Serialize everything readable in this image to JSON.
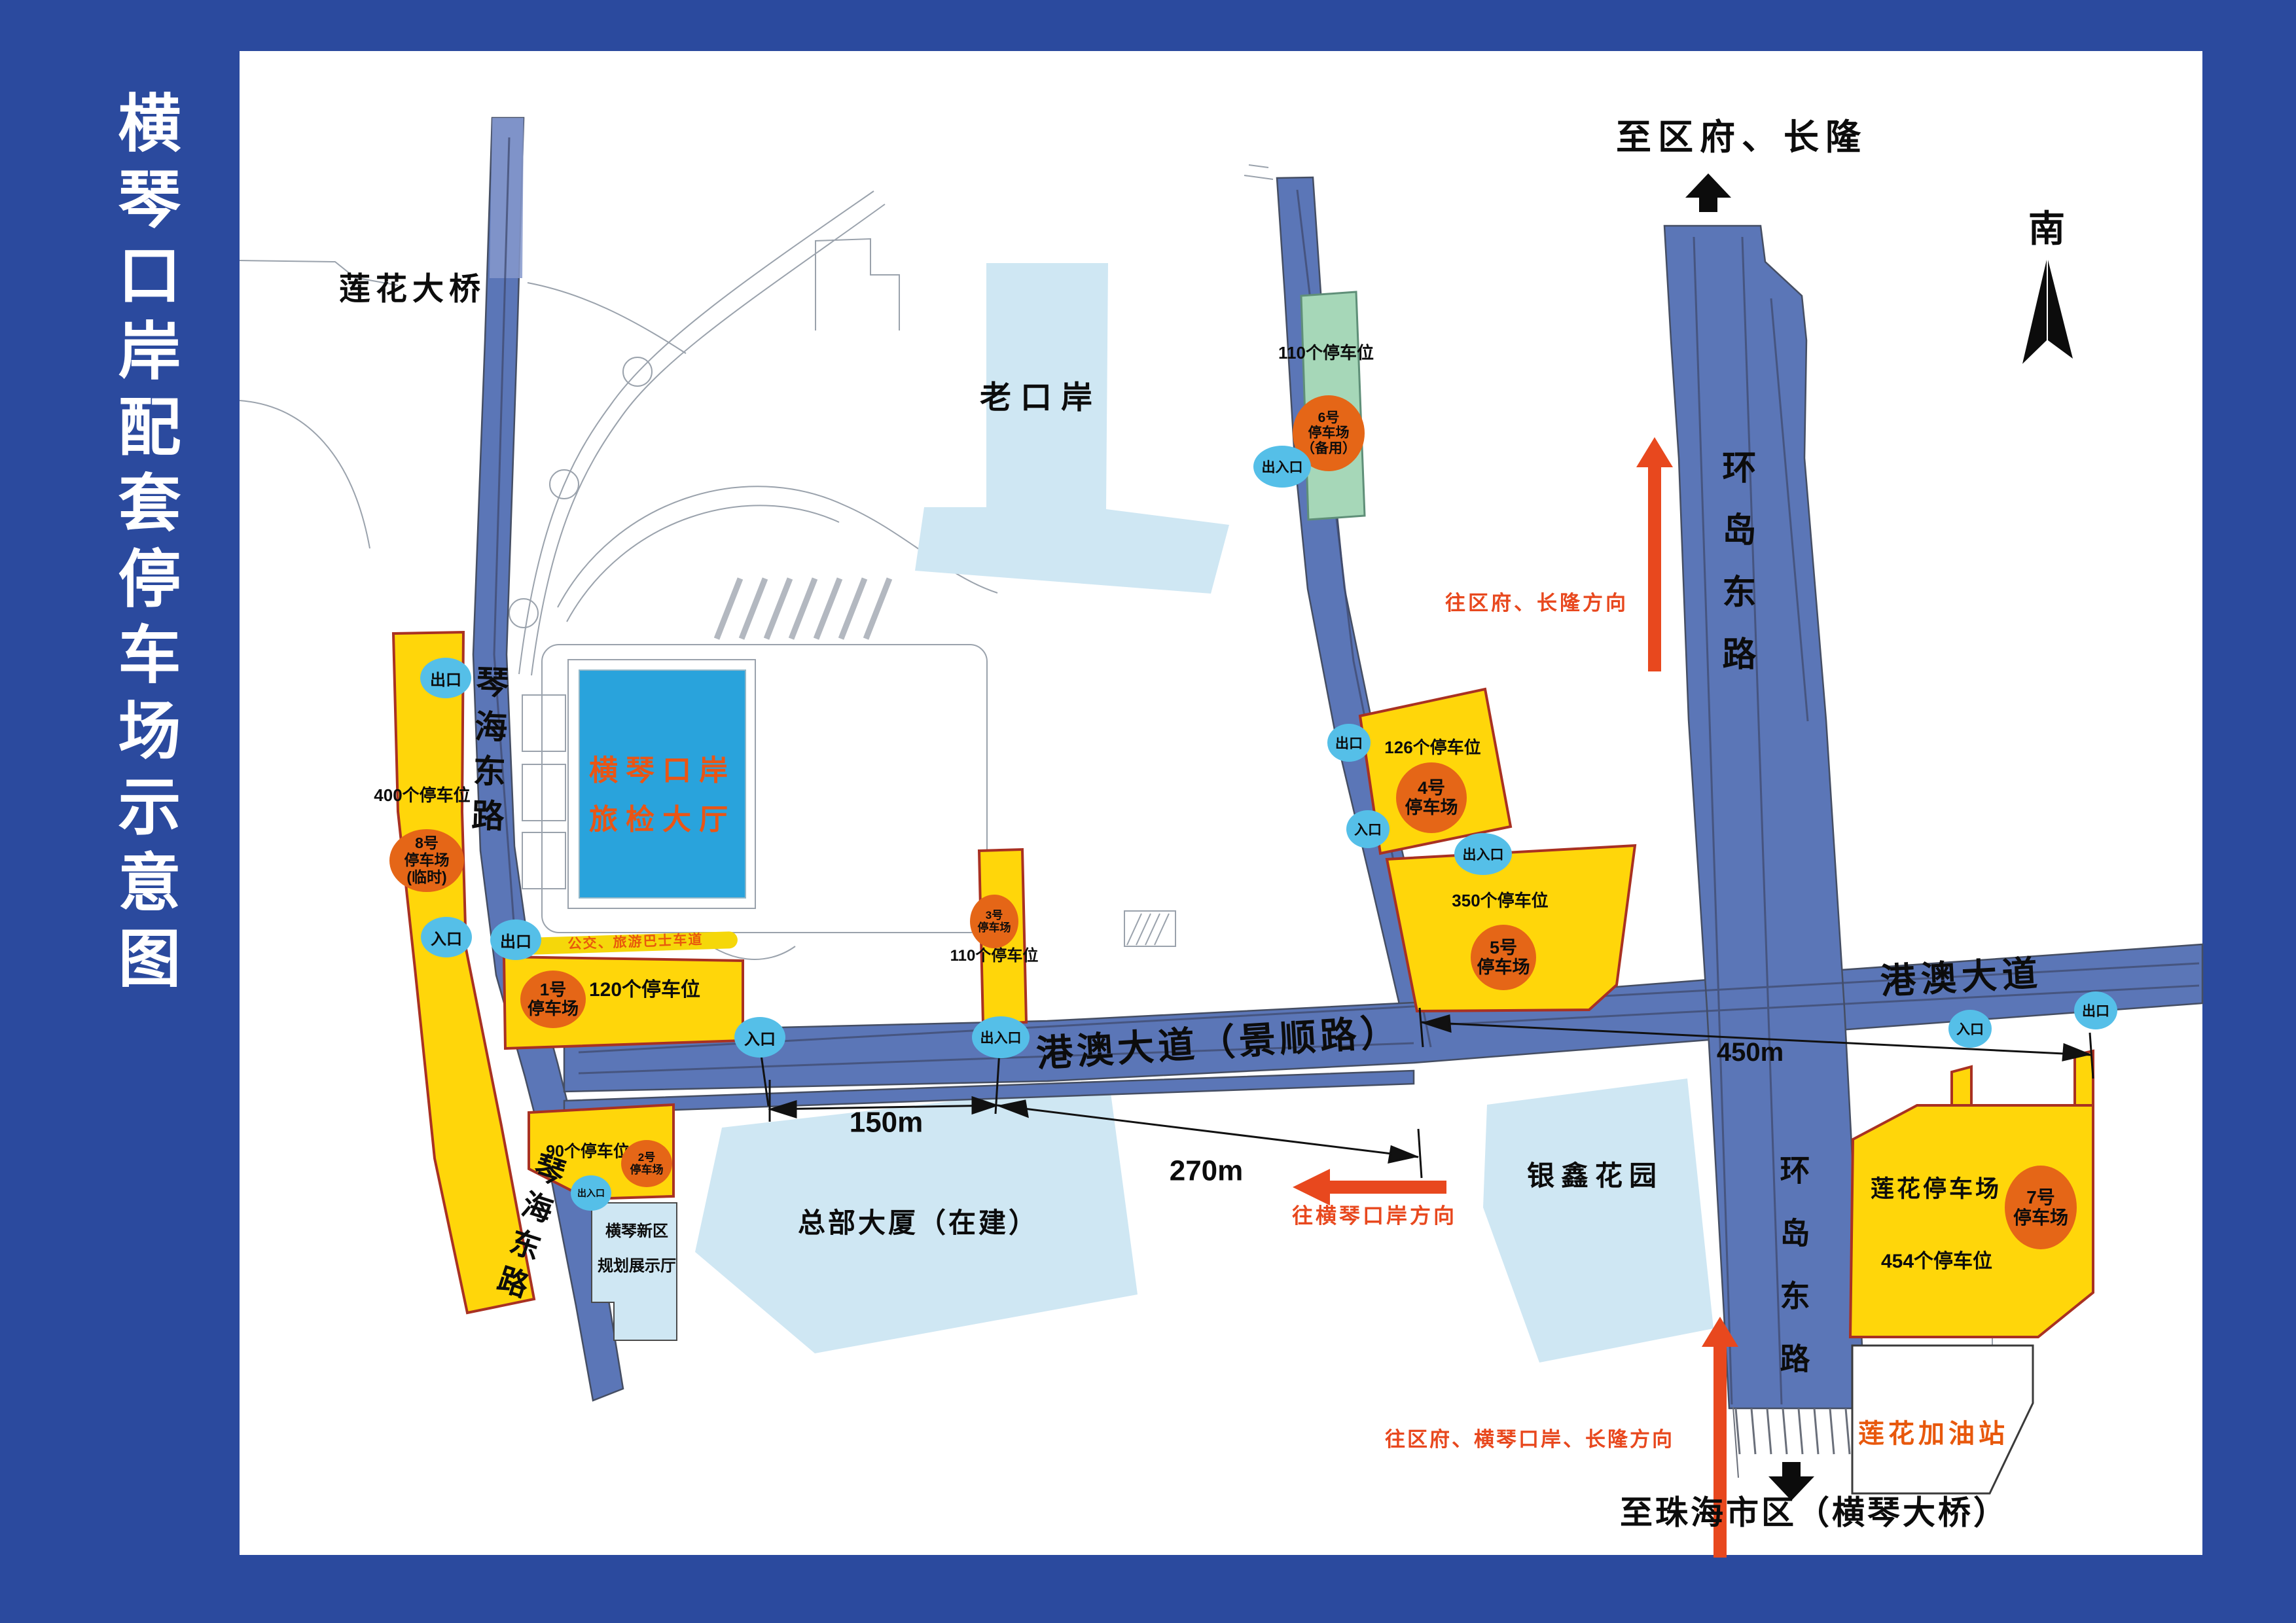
{
  "sidebar": {
    "title": "横琴口岸配套停车场示意图"
  },
  "compass": {
    "south": "南"
  },
  "labels": {
    "lianhua_bridge": "莲花大桥",
    "old_port": "老口岸",
    "to_qufu_changlong": "至区府、长隆",
    "to_zhuhai": "至珠海市区（横琴大桥）",
    "dir_qufu_changlong": "往区府、长隆方向",
    "dir_hengqin_port": "往横琴口岸方向",
    "dir_qufu_hengqin_changlong": "往区府、横琴口岸、长隆方向"
  },
  "roads": {
    "qinhai_east": "琴海东路",
    "huandao_east": "环岛东路",
    "gangao_jingshun": "港澳大道（景顺路）",
    "gangao": "港澳大道",
    "bus_lane": "公交、旅游巴士车道"
  },
  "buildings": {
    "inspection_hall": "横琴口岸\n旅检大厅",
    "exhibition_hall": "横琴新区\n规划展示厅",
    "hq_tower": "总部大厦（在建）",
    "yinxin_garden": "银鑫花园",
    "gas_station": "莲花加油站",
    "lianhua_lot": "莲花停车场"
  },
  "lots": {
    "p1": {
      "name": "1号\n停车场",
      "capacity": "120个停车位"
    },
    "p2": {
      "name": "2号\n停车场",
      "capacity": "90个停车位"
    },
    "p3": {
      "name": "3号\n停车场",
      "capacity": "110个停车位"
    },
    "p4": {
      "name": "4号\n停车场",
      "capacity": "126个停车位"
    },
    "p5": {
      "name": "5号\n停车场",
      "capacity": "350个停车位"
    },
    "p6": {
      "name": "6号\n停车场\n（备用）",
      "capacity": "110个停车位"
    },
    "p7": {
      "name": "7号\n停车场",
      "capacity": "454个停车位"
    },
    "p8": {
      "name": "8号\n停车场\n(临时)",
      "capacity": "400个停车位"
    }
  },
  "gates": {
    "exit": "出口",
    "entrance": "入口",
    "both": "出入口"
  },
  "dimensions": {
    "d150": "150m",
    "d270": "270m",
    "d450": "450m"
  },
  "colors": {
    "frame": "#2b4a9e",
    "road": "#5b76b7",
    "lot_yellow": "#ffd60a",
    "lot_border": "#a93122",
    "circle_orange": "#e56617",
    "gate_blue": "#55bfe8",
    "area_lightblue": "#cfe7f3",
    "lot_green": "#a6d7b8",
    "hall_blue": "#29a3dc",
    "accent_red": "#e8481e",
    "accent_orange": "#e8580c"
  }
}
